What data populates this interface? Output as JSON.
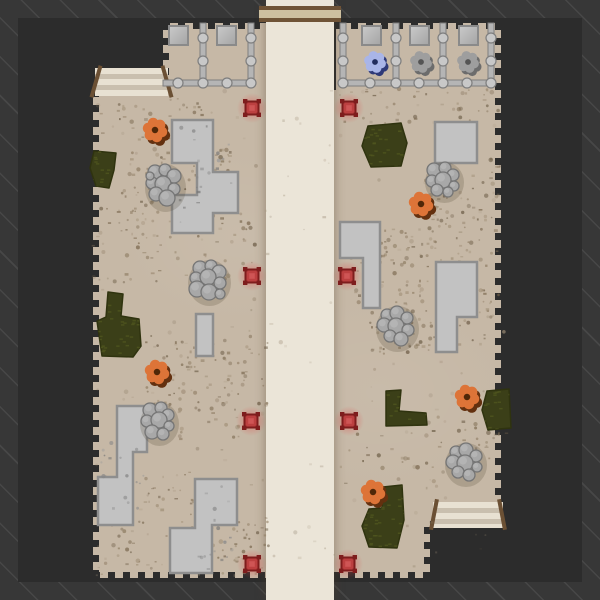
{
  "scene": {
    "colors": {
      "hatch_bg": "#373737",
      "hatch_line": "#474747",
      "void": "#2c2c2c",
      "ground": "#c6b8a6",
      "road": "#ebe5d8",
      "beam_wood": "#6f5336",
      "beam_fill": "#cdbf9f",
      "slab_fill": "#c2c2c2",
      "slab_edge": "#8e8e8e",
      "rock_fill": "#a8a8a8",
      "rock_edge": "#757575",
      "bush_fill": "#3b3f18",
      "bush_dash": "#4f551f",
      "bush_edge": "#2f330f",
      "pipe": "#b5b5b5",
      "pipe_edge": "#7e7e7e",
      "joint": "#c8c8c8",
      "pad_light": "#cacaca",
      "pad_dark": "#a4a4a4",
      "pad_edge": "#8a8a8a",
      "ramp_light": "#e8e1d2",
      "ramp_dark": "#c9bfae",
      "rail": "#6b5034",
      "marker_red": "#bc4040",
      "marker_dark": "#7e1d1d",
      "marker_inner": "#d05858",
      "marker_glow": "#e13c3c",
      "critter_body": "#dd7438",
      "critter_shadow": "#63300f",
      "critter_center": "#4f2708",
      "turret_blue_body": "#a9b5e8",
      "turret_blue_shadow": "#2f3a78",
      "turret_blue_center": "#222d5e",
      "turret_gray_body": "#9e9e9e",
      "turret_gray_shadow": "#6c6c6c",
      "turret_gray_center": "#545454"
    }
  },
  "fence": {
    "pads": [
      [
        169,
        26
      ],
      [
        217,
        26
      ],
      [
        362,
        26
      ],
      [
        410,
        26
      ],
      [
        459,
        26
      ]
    ],
    "pipes": [
      [
        163,
        80,
        92,
        6
      ],
      [
        341,
        80,
        152,
        6
      ],
      [
        200,
        23,
        6,
        63
      ],
      [
        248,
        23,
        6,
        63
      ],
      [
        340,
        23,
        6,
        63
      ],
      [
        393,
        23,
        6,
        63
      ],
      [
        440,
        23,
        6,
        63
      ],
      [
        488,
        23,
        6,
        63
      ]
    ],
    "joints": [
      [
        203,
        38
      ],
      [
        203,
        61
      ],
      [
        203,
        83
      ],
      [
        251,
        38
      ],
      [
        251,
        61
      ],
      [
        251,
        83
      ],
      [
        178,
        83
      ],
      [
        227,
        83
      ],
      [
        343,
        38
      ],
      [
        343,
        61
      ],
      [
        343,
        83
      ],
      [
        396,
        38
      ],
      [
        396,
        61
      ],
      [
        396,
        83
      ],
      [
        443,
        38
      ],
      [
        443,
        61
      ],
      [
        443,
        83
      ],
      [
        491,
        38
      ],
      [
        491,
        61
      ],
      [
        491,
        83
      ],
      [
        370,
        83
      ],
      [
        419,
        83
      ],
      [
        467,
        83
      ]
    ]
  },
  "turrets": [
    {
      "x": 375,
      "y": 62,
      "type": "blue"
    },
    {
      "x": 421,
      "y": 62,
      "type": "gray"
    },
    {
      "x": 468,
      "y": 62,
      "type": "gray"
    }
  ],
  "critters": [
    [
      155,
      130
    ],
    [
      157,
      372
    ],
    [
      421,
      204
    ],
    [
      467,
      397
    ],
    [
      373,
      492
    ]
  ],
  "spawn_markers": [
    [
      252,
      108
    ],
    [
      349,
      108
    ],
    [
      252,
      276
    ],
    [
      347,
      276
    ],
    [
      251,
      421
    ],
    [
      349,
      421
    ],
    [
      252,
      564
    ],
    [
      348,
      564
    ]
  ],
  "ramps": [
    {
      "x": 95,
      "y": 68,
      "w": 73,
      "h": 28,
      "lean": 16
    },
    {
      "x": 433,
      "y": 502,
      "w": 70,
      "h": 26,
      "lean": 11
    }
  ],
  "slabs": [
    {
      "points": [
        [
          172,
          120
        ],
        [
          213,
          120
        ],
        [
          213,
          172
        ],
        [
          238,
          172
        ],
        [
          238,
          213
        ],
        [
          213,
          213
        ],
        [
          213,
          233
        ],
        [
          172,
          233
        ],
        [
          172,
          195
        ],
        [
          197,
          195
        ],
        [
          197,
          163
        ],
        [
          172,
          163
        ]
      ]
    },
    {
      "points": [
        [
          196,
          314
        ],
        [
          213,
          314
        ],
        [
          213,
          356
        ],
        [
          196,
          356
        ]
      ]
    },
    {
      "points": [
        [
          117,
          406
        ],
        [
          147,
          406
        ],
        [
          147,
          452
        ],
        [
          133,
          452
        ],
        [
          133,
          525
        ],
        [
          98,
          525
        ],
        [
          98,
          477
        ],
        [
          117,
          477
        ]
      ]
    },
    {
      "points": [
        [
          195,
          479
        ],
        [
          237,
          479
        ],
        [
          237,
          525
        ],
        [
          212,
          525
        ],
        [
          212,
          573
        ],
        [
          170,
          573
        ],
        [
          170,
          528
        ],
        [
          195,
          528
        ]
      ]
    },
    {
      "points": [
        [
          435,
          122
        ],
        [
          477,
          122
        ],
        [
          477,
          163
        ],
        [
          435,
          163
        ]
      ]
    },
    {
      "points": [
        [
          340,
          222
        ],
        [
          380,
          222
        ],
        [
          380,
          308
        ],
        [
          363,
          308
        ],
        [
          363,
          258
        ],
        [
          340,
          258
        ]
      ]
    },
    {
      "points": [
        [
          436,
          262
        ],
        [
          477,
          262
        ],
        [
          477,
          317
        ],
        [
          457,
          317
        ],
        [
          457,
          352
        ],
        [
          436,
          352
        ]
      ]
    }
  ],
  "rocks": [
    {
      "circles": [
        [
          155,
          172,
          7
        ],
        [
          165,
          170,
          6
        ],
        [
          174,
          176,
          7
        ],
        [
          152,
          183,
          6
        ],
        [
          163,
          184,
          8
        ],
        [
          174,
          189,
          6
        ],
        [
          156,
          194,
          7
        ],
        [
          167,
          198,
          8
        ],
        [
          150,
          176,
          4
        ]
      ]
    },
    {
      "circles": [
        [
          200,
          268,
          7
        ],
        [
          211,
          266,
          6
        ],
        [
          219,
          272,
          7
        ],
        [
          196,
          278,
          6
        ],
        [
          208,
          277,
          8
        ],
        [
          220,
          283,
          6
        ],
        [
          197,
          289,
          8
        ],
        [
          209,
          292,
          8
        ],
        [
          220,
          294,
          5
        ]
      ]
    },
    {
      "circles": [
        [
          150,
          410,
          7
        ],
        [
          161,
          408,
          6
        ],
        [
          168,
          415,
          6
        ],
        [
          147,
          421,
          6
        ],
        [
          159,
          420,
          8
        ],
        [
          169,
          426,
          5
        ],
        [
          152,
          432,
          7
        ],
        [
          163,
          434,
          6
        ]
      ]
    },
    {
      "circles": [
        [
          434,
          170,
          7
        ],
        [
          445,
          168,
          6
        ],
        [
          453,
          175,
          6
        ],
        [
          432,
          181,
          6
        ],
        [
          443,
          180,
          8
        ],
        [
          454,
          186,
          5
        ],
        [
          437,
          190,
          6
        ],
        [
          448,
          192,
          5
        ]
      ]
    },
    {
      "circles": [
        [
          387,
          315,
          6
        ],
        [
          397,
          313,
          7
        ],
        [
          407,
          318,
          6
        ],
        [
          384,
          325,
          7
        ],
        [
          396,
          326,
          8
        ],
        [
          408,
          330,
          6
        ],
        [
          390,
          336,
          6
        ],
        [
          401,
          339,
          7
        ]
      ]
    },
    {
      "circles": [
        [
          456,
          452,
          6
        ],
        [
          466,
          450,
          7
        ],
        [
          476,
          456,
          6
        ],
        [
          453,
          462,
          7
        ],
        [
          465,
          463,
          8
        ],
        [
          477,
          467,
          5
        ],
        [
          458,
          472,
          6
        ],
        [
          469,
          475,
          6
        ]
      ]
    }
  ],
  "bushes": [
    {
      "points": [
        [
          94,
          151
        ],
        [
          116,
          153
        ],
        [
          114,
          170
        ],
        [
          109,
          188
        ],
        [
          96,
          186
        ],
        [
          90,
          168
        ]
      ]
    },
    {
      "points": [
        [
          108,
          292
        ],
        [
          123,
          294
        ],
        [
          121,
          316
        ],
        [
          139,
          319
        ],
        [
          141,
          346
        ],
        [
          133,
          357
        ],
        [
          102,
          356
        ],
        [
          97,
          321
        ],
        [
          106,
          317
        ]
      ]
    },
    {
      "points": [
        [
          368,
          126
        ],
        [
          401,
          123
        ],
        [
          407,
          143
        ],
        [
          401,
          166
        ],
        [
          371,
          167
        ],
        [
          362,
          146
        ]
      ]
    },
    {
      "points": [
        [
          386,
          391
        ],
        [
          401,
          390
        ],
        [
          399,
          411
        ],
        [
          426,
          413
        ],
        [
          427,
          425
        ],
        [
          386,
          426
        ]
      ]
    },
    {
      "points": [
        [
          487,
          391
        ],
        [
          509,
          389
        ],
        [
          511,
          428
        ],
        [
          488,
          430
        ],
        [
          482,
          410
        ]
      ]
    },
    {
      "points": [
        [
          383,
          487
        ],
        [
          402,
          485
        ],
        [
          404,
          520
        ],
        [
          397,
          548
        ],
        [
          369,
          547
        ],
        [
          362,
          526
        ],
        [
          369,
          509
        ],
        [
          382,
          508
        ]
      ]
    }
  ],
  "speckle_clusters": [
    {
      "x": 98,
      "y": 96,
      "w": 115,
      "h": 45,
      "n": 45
    },
    {
      "x": 112,
      "y": 148,
      "w": 125,
      "h": 75,
      "n": 90
    },
    {
      "x": 90,
      "y": 198,
      "w": 165,
      "h": 85,
      "n": 70
    },
    {
      "x": 145,
      "y": 335,
      "w": 125,
      "h": 105,
      "n": 120
    },
    {
      "x": 95,
      "y": 470,
      "w": 115,
      "h": 105,
      "n": 80
    },
    {
      "x": 195,
      "y": 515,
      "w": 75,
      "h": 60,
      "n": 55
    },
    {
      "x": 340,
      "y": 88,
      "w": 160,
      "h": 35,
      "n": 40
    },
    {
      "x": 425,
      "y": 155,
      "w": 75,
      "h": 110,
      "n": 80
    },
    {
      "x": 350,
      "y": 228,
      "w": 85,
      "h": 75,
      "n": 75
    },
    {
      "x": 430,
      "y": 285,
      "w": 75,
      "h": 60,
      "n": 45
    },
    {
      "x": 370,
      "y": 300,
      "w": 60,
      "h": 60,
      "n": 35
    },
    {
      "x": 435,
      "y": 415,
      "w": 70,
      "h": 45,
      "n": 30
    },
    {
      "x": 337,
      "y": 430,
      "w": 100,
      "h": 60,
      "n": 25
    },
    {
      "x": 93,
      "y": 90,
      "w": 405,
      "h": 485,
      "n": 170,
      "alpha": 0.3
    },
    {
      "x": 176,
      "y": 124,
      "w": 55,
      "h": 100,
      "n": 22,
      "palette": "slab"
    },
    {
      "x": 197,
      "y": 482,
      "w": 38,
      "h": 88,
      "n": 18,
      "palette": "slab"
    },
    {
      "x": 100,
      "y": 440,
      "w": 45,
      "h": 80,
      "n": 16,
      "palette": "slab"
    }
  ],
  "speckle_palette": [
    "#8f7d64",
    "#7d6b52",
    "#a19078",
    "#6f5f49"
  ],
  "slab_speckle_palette": [
    "#9a9a9a",
    "#878787",
    "#767676"
  ]
}
